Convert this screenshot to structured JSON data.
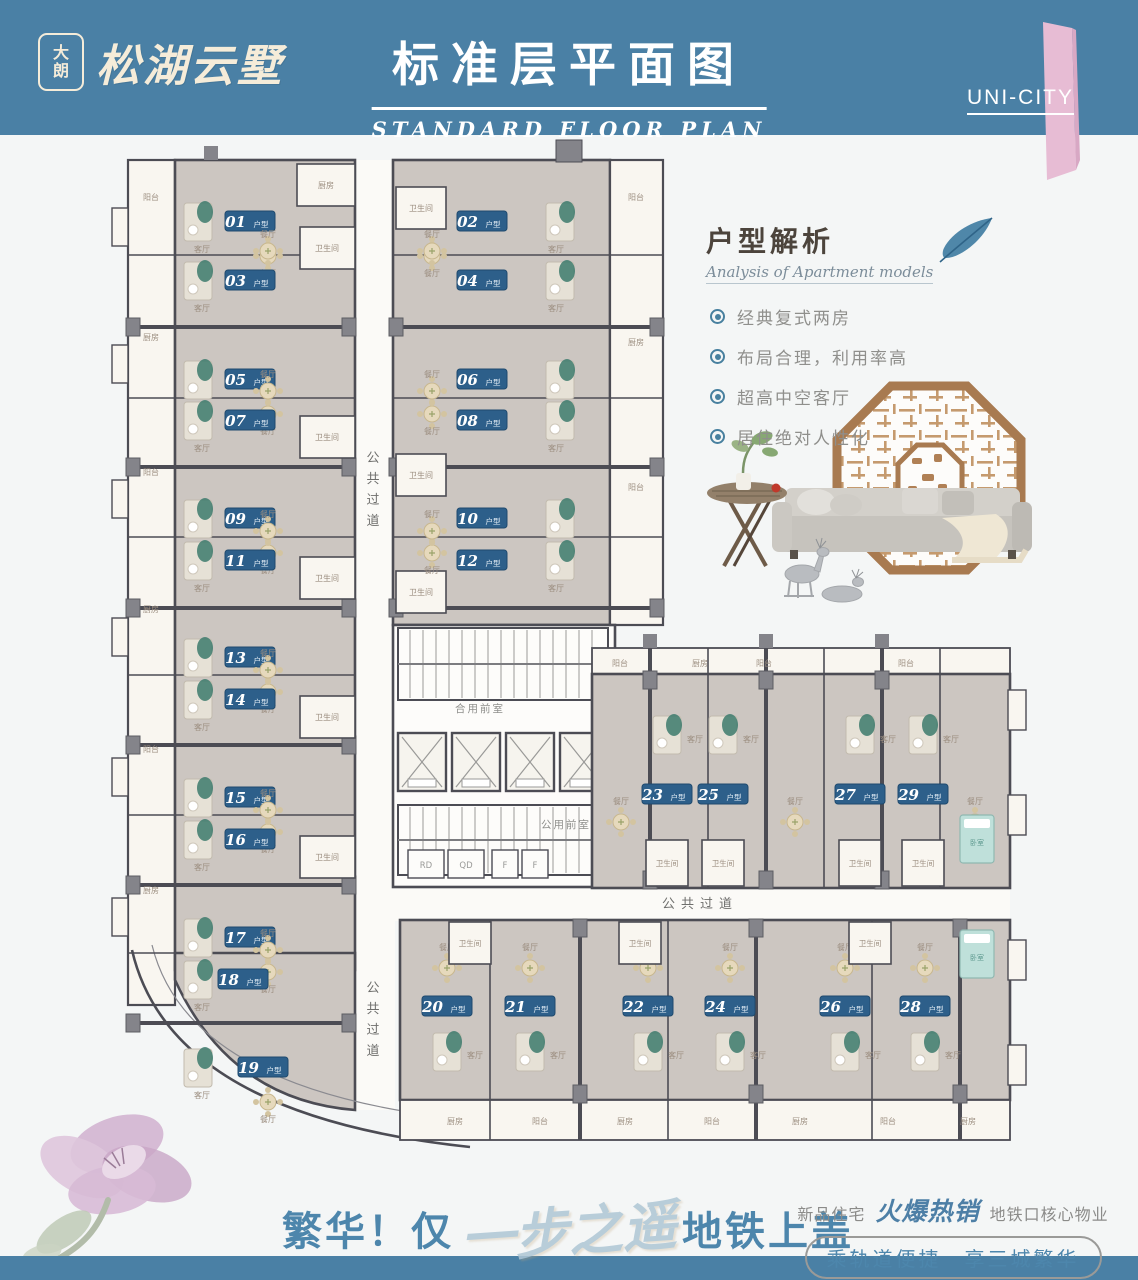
{
  "header": {
    "logo_badge_chars": [
      "大",
      "朗"
    ],
    "logo_name": "松湖云墅",
    "title": "标准层平面图",
    "subtitle": "STANDARD FLOOR PLAN",
    "ribbon_label": "UNI-CITY"
  },
  "analysis": {
    "title": "户型解析",
    "subtitle": "Analysis of Apartment models",
    "bullets": [
      "经典复式两房",
      "布局合理，利用率高",
      "超高中空客厅",
      "居住绝对人性化"
    ]
  },
  "floorplan": {
    "unit_suffix": "户型",
    "left_units": [
      "01",
      "03",
      "05",
      "07",
      "09",
      "11",
      "13",
      "14",
      "15",
      "16",
      "17",
      "18",
      "19"
    ],
    "mid_units": [
      "02",
      "04",
      "06",
      "08",
      "10",
      "12"
    ],
    "wing_top_units": [
      "23",
      "25",
      "27",
      "29"
    ],
    "wing_bottom_units": [
      "20",
      "21",
      "22",
      "24",
      "26",
      "28"
    ],
    "corridor_label": "公共过道",
    "lobby_labels": [
      "合用前室",
      "公用前室"
    ],
    "service_labels": [
      "RD",
      "QD",
      "F",
      "F"
    ],
    "rooms": {
      "living": "客厅",
      "dining": "餐厅",
      "bath": "卫生间",
      "kitchen": "厨房",
      "balcony": "阳台",
      "bedroom": "卧室"
    }
  },
  "tagline": {
    "left": "繁华！仅",
    "script": "一步之遥",
    "right": "地铁上盖"
  },
  "promo": {
    "prefix": "新品住宅",
    "hot": "火爆热销",
    "suffix": "地铁口核心物业",
    "pill": "乘轨道便捷　享三城繁华"
  },
  "colors": {
    "header_band": "#4a80a5",
    "ribbon_pink": "#e7bcd4",
    "chip_blue": "#2d5f8a",
    "unit_fill": "#ccc6c1",
    "side_room_fill": "#f9f6f0",
    "wall": "#4c4c54",
    "column": "#84848a",
    "accent_teal": "#3c7a6c",
    "accent_blue": "#4d86ac",
    "room_text": "#9c8e80",
    "beige": "#e6d9bc"
  }
}
